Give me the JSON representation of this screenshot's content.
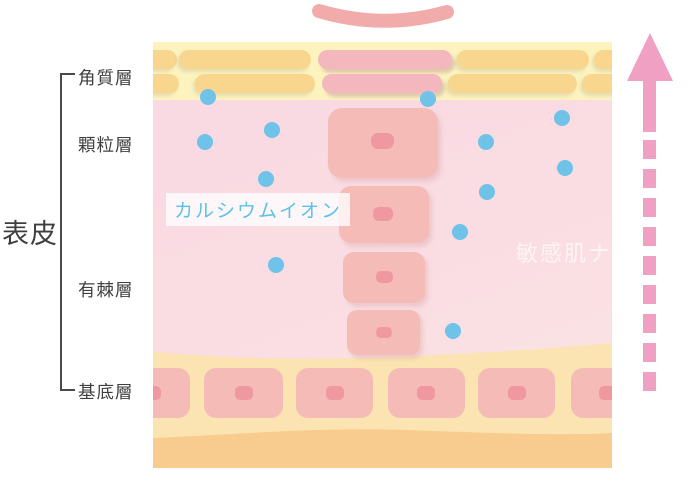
{
  "diagram": {
    "title_hidden": "",
    "epidermis_label": "表皮",
    "layers": [
      {
        "name": "角質層"
      },
      {
        "name": "顆粒層"
      },
      {
        "name": "有棘層"
      },
      {
        "name": "基底層"
      }
    ],
    "annotation": {
      "calcium_ion": "カルシウムイオン"
    },
    "watermark": "敏感肌ナビ",
    "icons": {
      "up_arrow": "up-arrow",
      "calcium_dot": "calcium-ion-dot",
      "flake": "desquamating-corneocyte"
    },
    "colors": {
      "corneum_background": "#fcf3be",
      "corneum_bar_yellow": "#f8d68d",
      "corneum_bar_pink": "#f3b7bd",
      "epidermis_pink": "#f9d8e2",
      "basal_band_yellow": "#fbe4b2",
      "dermis_orange": "#f8cc8f",
      "cell_pink": "#f5bcb7",
      "nucleus_pink": "#f0989f",
      "ion_blue": "#6fc2e8",
      "arrow_pink": "#efa0c3",
      "label_text": "#3f3f3f",
      "calcium_text": "#5ec1e7"
    }
  }
}
